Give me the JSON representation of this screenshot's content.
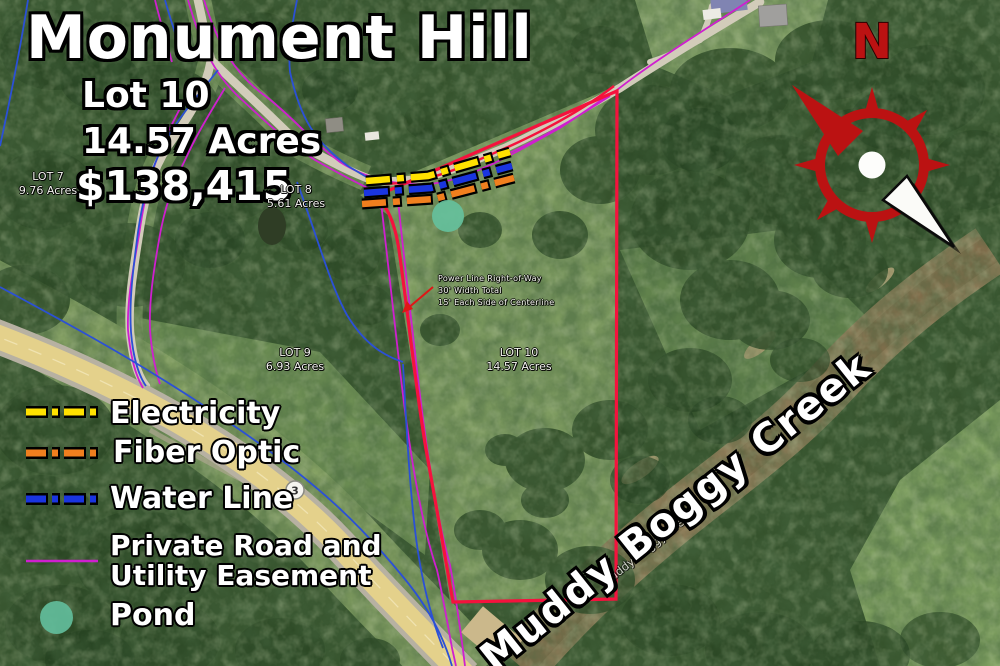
{
  "title": "Monument Hill",
  "listing": {
    "lot": "Lot 10",
    "acres": "14.57 Acres",
    "price": "$138,415"
  },
  "legend": {
    "items": [
      {
        "label": "Electricity",
        "color": "#ffe100",
        "style": "dash-dot-outlined"
      },
      {
        "label": "Fiber Optic",
        "color": "#f07f1e",
        "style": "dash-dot-outlined"
      },
      {
        "label": "Water Line",
        "color": "#1a35e0",
        "style": "dash-dot-outlined"
      },
      {
        "label": "Private Road and\nUtility Easement",
        "color": "#cf1fcf",
        "style": "thin-solid"
      },
      {
        "label": "Pond",
        "color": "#62bd9b",
        "style": "filled-circle"
      }
    ]
  },
  "lots": [
    {
      "name": "LOT 7",
      "acres": "9.76 Acres"
    },
    {
      "name": "LOT 8",
      "acres": "5.61 Acres"
    },
    {
      "name": "LOT 9",
      "acres": "6.93 Acres"
    },
    {
      "name": "LOT 10",
      "acres": "14.57 Acres"
    }
  ],
  "annotations": {
    "power_line": "Power Line Right-of-Way\n30' Width Total\n15' Each Side of Centerline",
    "creek_name": "Muddy Boggy Creek",
    "creek_name_basemap": "Muddy Boggy Creek",
    "route_shield": "3",
    "compass_north": "N"
  },
  "map_colors": {
    "boundary_red": "#f5123d",
    "easement_magenta": "#cf1fcf",
    "water_blue": "#2b50d6",
    "electricity_yellow": "#ffe100",
    "fiber_orange": "#f07f1e",
    "pond_teal": "#62bd9b",
    "compass_red": "#bb1212"
  }
}
